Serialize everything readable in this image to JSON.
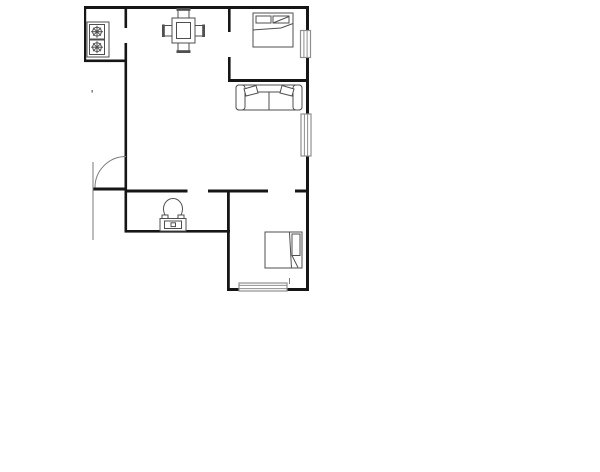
{
  "canvas": {
    "width": 600,
    "height": 472,
    "background": "#ffffff"
  },
  "palette": {
    "wall": "#161616",
    "furniture": "#4f4f4f",
    "window": "#8f8f8f",
    "door": "#7a7a7a"
  },
  "floor_plan": {
    "walls": [
      {
        "name": "exterior-top-wall",
        "x": 84,
        "y": 6,
        "w": 225,
        "h": 3
      },
      {
        "name": "kitchen-left-wall",
        "x": 84,
        "y": 6,
        "w": 2.2,
        "h": 56
      },
      {
        "name": "kitchen-bottom-wall",
        "x": 84,
        "y": 59.5,
        "w": 43,
        "h": 2.6
      },
      {
        "name": "kitchen-right-wall-upper",
        "x": 124.5,
        "y": 6,
        "w": 2.6,
        "h": 22
      },
      {
        "name": "living-left-wall",
        "x": 124.5,
        "y": 43,
        "w": 2.6,
        "h": 189.5
      },
      {
        "name": "hall-wall-left-segment",
        "x": 124.5,
        "y": 189.5,
        "w": 63,
        "h": 3
      },
      {
        "name": "hall-wall-mid-segment",
        "x": 208,
        "y": 189.5,
        "w": 60,
        "h": 3
      },
      {
        "name": "hall-wall-right-segment",
        "x": 295,
        "y": 189.5,
        "w": 14,
        "h": 3
      },
      {
        "name": "bathroom-bottom-wall",
        "x": 124.5,
        "y": 230,
        "w": 105.5,
        "h": 2.6
      },
      {
        "name": "bedroom2-left-wall",
        "x": 227,
        "y": 189.5,
        "w": 2.8,
        "h": 101.5
      },
      {
        "name": "bedroom2-bottom-wall",
        "x": 227,
        "y": 288,
        "w": 82,
        "h": 3
      },
      {
        "name": "bedroom1-left-wall-upper",
        "x": 228,
        "y": 6,
        "w": 2.6,
        "h": 26
      },
      {
        "name": "bedroom1-left-wall-lower",
        "x": 228,
        "y": 57,
        "w": 2.6,
        "h": 25
      },
      {
        "name": "bedroom1-bottom-wall",
        "x": 228,
        "y": 79,
        "w": 81,
        "h": 3
      },
      {
        "name": "exterior-right-wall-upper",
        "x": 306,
        "y": 6,
        "w": 3,
        "h": 25
      },
      {
        "name": "exterior-right-wall-mid",
        "x": 306,
        "y": 57,
        "w": 3,
        "h": 58
      },
      {
        "name": "exterior-right-wall-lower",
        "x": 306,
        "y": 155,
        "w": 3,
        "h": 136
      },
      {
        "name": "entry-door-threshold",
        "x": 93,
        "y": 187.5,
        "w": 33.5,
        "h": 3
      }
    ],
    "windows": [
      {
        "name": "bedroom1-window",
        "x": 300.5,
        "y": 30.5,
        "w": 10,
        "h": 27,
        "inner": "v"
      },
      {
        "name": "living-room-window",
        "x": 301,
        "y": 114,
        "w": 10,
        "h": 42,
        "inner": "v"
      },
      {
        "name": "bedroom2-window",
        "x": 239,
        "y": 283,
        "w": 48,
        "h": 8,
        "inner": "h"
      }
    ],
    "door": {
      "name": "entry-door",
      "swing_arc_path": "M 95 187.5 A 31 31 0 0 1 126 156.5",
      "leaf_line": {
        "x1": 93,
        "y1": 162,
        "x2": 93,
        "y2": 240
      }
    },
    "furniture": [
      {
        "name": "stove",
        "shapes": [
          {
            "t": "rect",
            "x": 87,
            "y": 22,
            "w": 22,
            "h": 35
          },
          {
            "t": "rect",
            "x": 89.5,
            "y": 24.5,
            "w": 15,
            "h": 14.5
          },
          {
            "t": "rect",
            "x": 89.5,
            "y": 40,
            "w": 15,
            "h": 14.5
          },
          {
            "t": "circle",
            "cx": 97,
            "cy": 31.7,
            "r": 4.4
          },
          {
            "t": "line",
            "x1": 97,
            "y1": 25.7,
            "x2": 97,
            "y2": 37.7
          },
          {
            "t": "line",
            "x1": 91,
            "y1": 31.7,
            "x2": 103,
            "y2": 31.7
          },
          {
            "t": "line",
            "x1": 93,
            "y1": 27.7,
            "x2": 101,
            "y2": 35.7
          },
          {
            "t": "line",
            "x1": 93,
            "y1": 35.7,
            "x2": 101,
            "y2": 27.7
          },
          {
            "t": "circle",
            "cx": 97,
            "cy": 31.7,
            "r": 1.4,
            "f": 1
          },
          {
            "t": "circle",
            "cx": 97,
            "cy": 47.2,
            "r": 4.4
          },
          {
            "t": "line",
            "x1": 97,
            "y1": 41.2,
            "x2": 97,
            "y2": 53.2
          },
          {
            "t": "line",
            "x1": 91,
            "y1": 47.2,
            "x2": 103,
            "y2": 47.2
          },
          {
            "t": "line",
            "x1": 93,
            "y1": 43.2,
            "x2": 101,
            "y2": 51.2
          },
          {
            "t": "line",
            "x1": 93,
            "y1": 51.2,
            "x2": 101,
            "y2": 43.2
          },
          {
            "t": "circle",
            "cx": 97,
            "cy": 47.2,
            "r": 1.4,
            "f": 1
          }
        ]
      },
      {
        "name": "dining-table",
        "shapes": [
          {
            "t": "rect",
            "x": 172,
            "y": 18,
            "w": 23,
            "h": 25
          },
          {
            "t": "rect",
            "x": 176.5,
            "y": 22.5,
            "w": 14,
            "h": 16
          },
          {
            "t": "rect",
            "x": 178,
            "y": 10,
            "w": 11,
            "h": 8
          },
          {
            "t": "rect",
            "x": 176.5,
            "y": 8,
            "w": 14,
            "h": 2.8,
            "f": 1
          },
          {
            "t": "rect",
            "x": 178,
            "y": 43,
            "w": 11,
            "h": 8
          },
          {
            "t": "rect",
            "x": 176.5,
            "y": 50.2,
            "w": 14,
            "h": 2.8,
            "f": 1
          },
          {
            "t": "rect",
            "x": 164,
            "y": 25.5,
            "w": 8,
            "h": 10.5
          },
          {
            "t": "rect",
            "x": 162,
            "y": 24.5,
            "w": 2.8,
            "h": 12.5,
            "f": 1
          },
          {
            "t": "rect",
            "x": 195,
            "y": 25.5,
            "w": 8,
            "h": 10.5
          },
          {
            "t": "rect",
            "x": 202.2,
            "y": 24.5,
            "w": 2.8,
            "h": 12.5,
            "f": 1
          }
        ]
      },
      {
        "name": "bed-1",
        "shapes": [
          {
            "t": "rect",
            "x": 253,
            "y": 13,
            "w": 40,
            "h": 34
          },
          {
            "t": "rect",
            "x": 256,
            "y": 16,
            "w": 15,
            "h": 7
          },
          {
            "t": "rect",
            "x": 273,
            "y": 16,
            "w": 16,
            "h": 7
          },
          {
            "t": "line",
            "x1": 253,
            "y1": 30,
            "x2": 281,
            "y2": 28
          },
          {
            "t": "line",
            "x1": 281,
            "y1": 28,
            "x2": 293,
            "y2": 23.5
          },
          {
            "t": "line",
            "x1": 273,
            "y1": 23,
            "x2": 289,
            "y2": 16.5
          }
        ]
      },
      {
        "name": "sofa",
        "shapes": [
          {
            "t": "rect",
            "x": 236,
            "y": 85,
            "w": 66,
            "h": 25,
            "rx": 3
          },
          {
            "t": "rect",
            "x": 236,
            "y": 85,
            "w": 9,
            "h": 25,
            "rx": 3
          },
          {
            "t": "rect",
            "x": 293,
            "y": 85,
            "w": 9,
            "h": 25,
            "rx": 3
          },
          {
            "t": "line",
            "x1": 245,
            "y1": 92,
            "x2": 293,
            "y2": 92
          },
          {
            "t": "line",
            "x1": 269,
            "y1": 92,
            "x2": 269,
            "y2": 110
          },
          {
            "t": "polygon",
            "p": "244,89 256,85.5 258,93 246,96"
          },
          {
            "t": "polygon",
            "p": "282,85.5 294,89 292,96 280,93"
          }
        ]
      },
      {
        "name": "toilet",
        "shapes": [
          {
            "t": "ellipse",
            "cx": 173,
            "cy": 209,
            "rx": 9.5,
            "ry": 10.5
          },
          {
            "t": "rect",
            "x": 162,
            "y": 215,
            "w": 6,
            "h": 4.5
          },
          {
            "t": "rect",
            "x": 178,
            "y": 215,
            "w": 6,
            "h": 4.5
          },
          {
            "t": "rect",
            "x": 160,
            "y": 218.5,
            "w": 26,
            "h": 12.5
          },
          {
            "t": "rect",
            "x": 164.5,
            "y": 221,
            "w": 17,
            "h": 7.5
          },
          {
            "t": "rect",
            "x": 171,
            "y": 222.8,
            "w": 4.5,
            "h": 3.8
          }
        ]
      },
      {
        "name": "bed-2",
        "shapes": [
          {
            "t": "rect",
            "x": 265,
            "y": 232,
            "w": 37,
            "h": 36
          },
          {
            "t": "line",
            "x1": 289.5,
            "y1": 232.5,
            "x2": 291.5,
            "y2": 268
          },
          {
            "t": "rect",
            "x": 292,
            "y": 234,
            "w": 8,
            "h": 21.5
          },
          {
            "t": "line",
            "x1": 292,
            "y1": 255.5,
            "x2": 298,
            "y2": 267.5
          }
        ]
      }
    ],
    "marks": [
      {
        "name": "bedroom2-window-tick",
        "t": "line",
        "x1": 289.5,
        "y1": 278,
        "x2": 289.5,
        "y2": 284
      },
      {
        "name": "stray-mark",
        "t": "rect",
        "x": 91.5,
        "y": 90,
        "w": 1.4,
        "h": 2.6,
        "f": 1
      }
    ]
  }
}
